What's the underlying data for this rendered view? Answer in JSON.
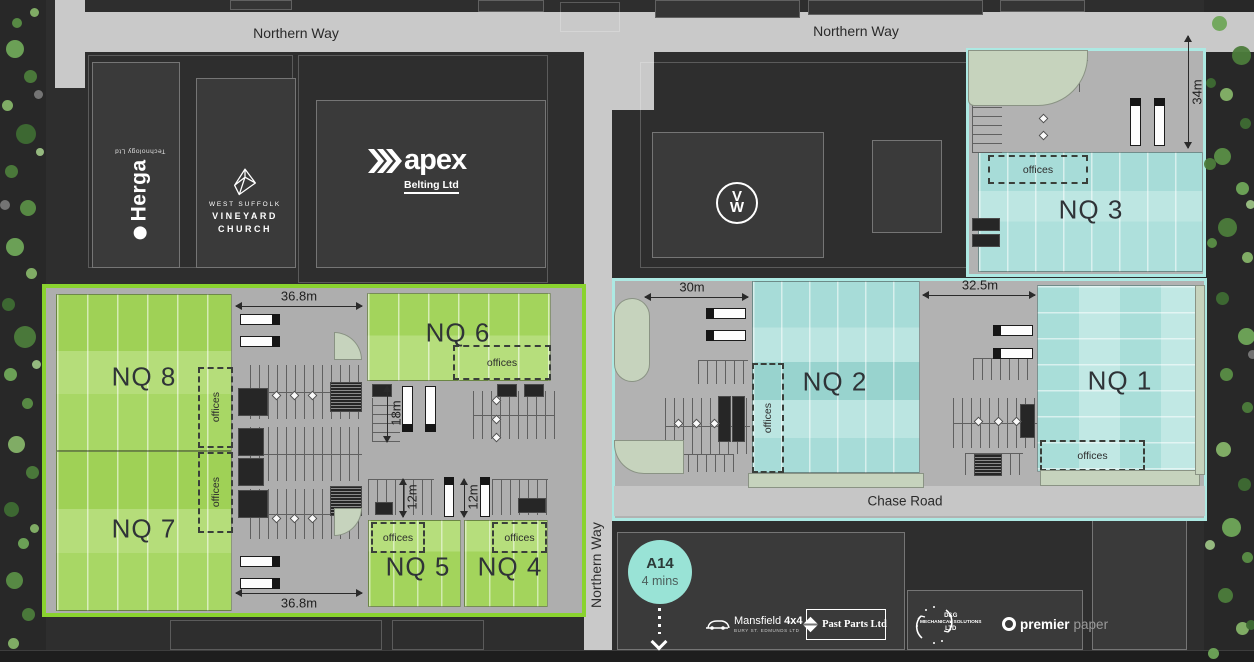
{
  "roads": {
    "northern_way_left": "Northern Way",
    "northern_way_right": "Northern Way",
    "northern_way_vertical": "Northern Way",
    "chase_road": "Chase Road"
  },
  "units": {
    "nq1": {
      "label": "NQ 1",
      "offices_label": "offices",
      "frontage": "32.5m"
    },
    "nq2": {
      "label": "NQ 2",
      "offices_label": "offices",
      "frontage": "30m"
    },
    "nq3": {
      "label": "NQ 3",
      "offices_label": "offices",
      "depth": "34m"
    },
    "nq4": {
      "label": "NQ 4",
      "offices_label": "offices",
      "yard_depth": "12m"
    },
    "nq5": {
      "label": "NQ 5",
      "offices_label": "offices",
      "yard_depth": "12m"
    },
    "nq6": {
      "label": "NQ 6",
      "offices_label": "offices",
      "yard_depth": "18m"
    },
    "nq7": {
      "label": "NQ 7",
      "offices_label": "offices",
      "frontage_bottom": "36.8m"
    },
    "nq8": {
      "label": "NQ 8",
      "offices_label": "offices",
      "frontage_top": "36.8m"
    }
  },
  "occupiers": {
    "herga": {
      "name": "Herga",
      "subtitle": "Technology Ltd"
    },
    "vineyard_church": {
      "line1": "WEST SUFFOLK",
      "line2": "VINEYARD",
      "line3": "CHURCH"
    },
    "apex": {
      "name": "apex",
      "subtitle": "Belting Ltd"
    },
    "volkswagen": {
      "monogram_top": "V",
      "monogram_bottom": "W"
    },
    "mansfield": {
      "name_regular": "Mansfield",
      "name_bold": "4x4",
      "subtitle": "BURY ST. EDMUNDS LTD"
    },
    "past_parts": {
      "name": "Past Parts Ltd"
    },
    "dg_mechanical": {
      "line1": "D&G",
      "line2": "MECHANICAL SOLUTIONS",
      "line3": "LTD"
    },
    "premier_paper": {
      "name_bold": "premier",
      "name_light": "paper"
    }
  },
  "transport": {
    "a14_label": "A14",
    "a14_time": "4 mins"
  },
  "colors": {
    "background": "#2e2e2e",
    "road": "#c9c9c9",
    "hardstanding": "#aeaeae",
    "green_unit": "#a3d45c",
    "green_unit_light": "#b6de7c",
    "green_site_outline": "#8ad32f",
    "teal_unit": "#a7dcd8",
    "teal_unit_light": "#bbe5e1",
    "teal_site_outline": "#ade9e3",
    "dark_building": "#3a3a3a",
    "landscape": "#c6d3bd",
    "a14_badge": "#99e3d6"
  }
}
